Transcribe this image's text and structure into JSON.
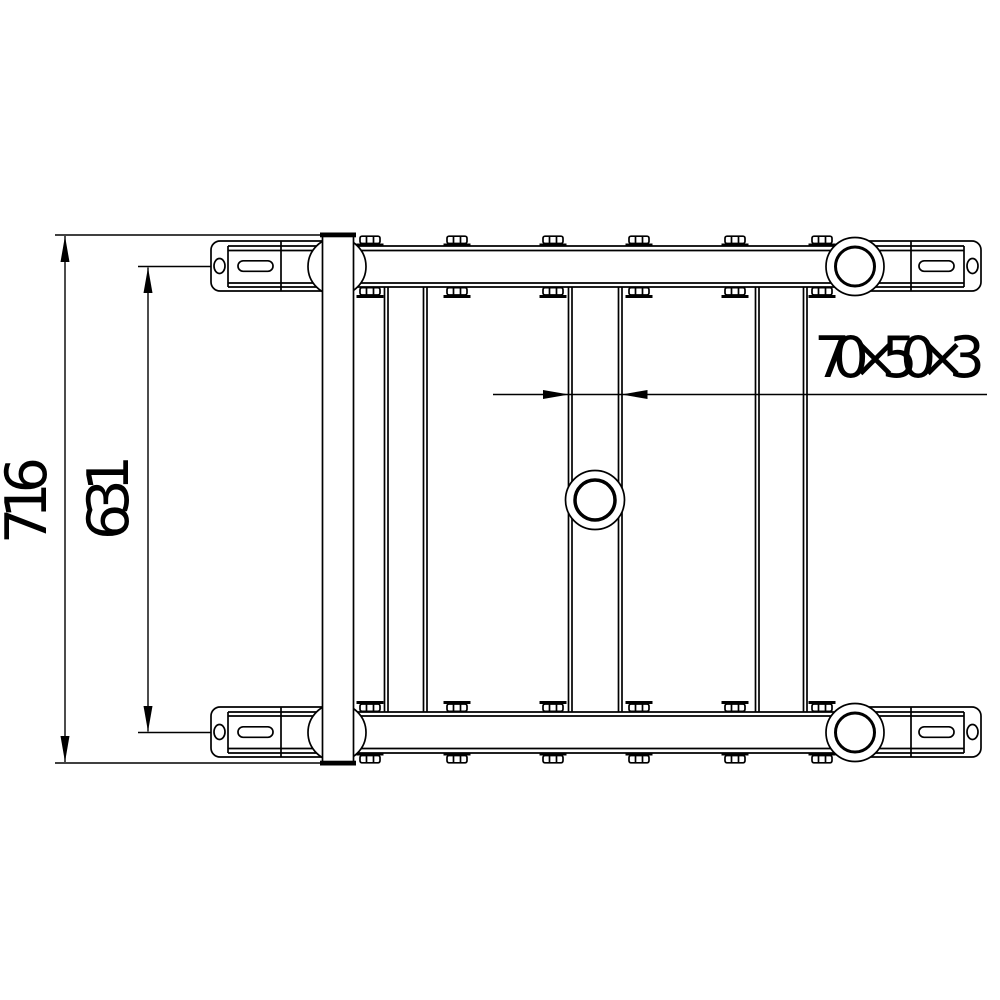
{
  "drawing": {
    "type": "technical-drawing",
    "dimensions": {
      "overall": "716",
      "inner": "631",
      "profile": "70×50×3"
    },
    "colors": {
      "line": "#000000",
      "background": "#ffffff"
    }
  }
}
